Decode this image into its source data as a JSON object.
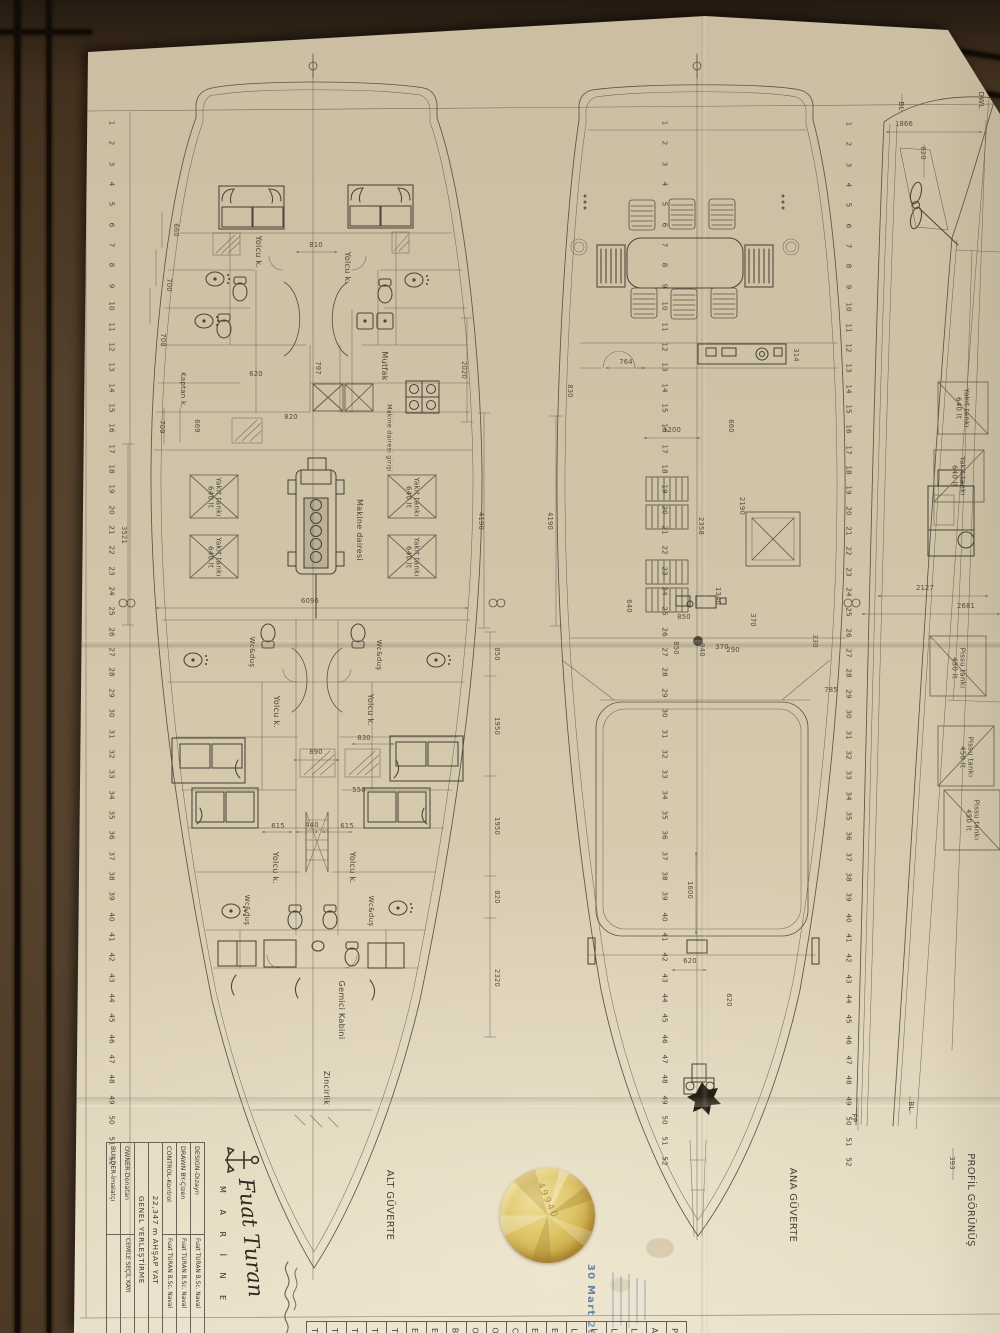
{
  "title_block": {
    "brand_script": "Fuat Turan",
    "brand_sub": "M A R İ N E",
    "rows": [
      {
        "label": "DESIGN-Dizayn",
        "value": "Fuat TURAN B.Sc. Naval"
      },
      {
        "label": "DRAWN BY-Çizen",
        "value": "Fuat TURAN B.Sc. Naval"
      },
      {
        "label": "CONTROL-Kontrol",
        "value": "Fuat TURAN B.Sc. Naval"
      }
    ],
    "boat": "22,347 m AHŞAP YAT",
    "drawing_title": "GENEL YERLEŞTİRME",
    "owner_label": "OWNER-Donatan",
    "owner_value": "CEMİLE SEÇİL KAYI",
    "builder_label": "BUILDER-İmalatçı",
    "builder_value": ""
  },
  "stamp": {
    "date": "30 Mart 2013 /"
  },
  "sticker": {
    "number": "49940"
  },
  "frames": {
    "start": 1,
    "end": 52
  },
  "rulers": [
    {
      "x": 112,
      "y0": 123,
      "dy": 20.35
    },
    {
      "x": 665,
      "y0": 123,
      "dy": 20.35
    },
    {
      "x": 849,
      "y0": 124,
      "dy": 20.35
    }
  ],
  "strip_letters": [
    "T",
    "T",
    "T",
    "T",
    "T",
    "E",
    "E",
    "B",
    "O",
    "O",
    "C",
    "E",
    "E",
    "L",
    "L",
    "L",
    "L",
    "A",
    "P"
  ],
  "annotations": {
    "labels": [
      {
        "text": "Yolcu k.",
        "x": 258,
        "y": 252,
        "v": 1
      },
      {
        "text": "Yolcu k.",
        "x": 347,
        "y": 268,
        "v": 1
      },
      {
        "text": "Mutfak",
        "x": 384,
        "y": 366,
        "v": 1
      },
      {
        "text": "Makine dairesi girişi",
        "x": 389,
        "y": 438,
        "v": 1,
        "fs": 6.2
      },
      {
        "text": "Kaptan k.",
        "x": 183,
        "y": 390,
        "v": 1,
        "fs": 7
      },
      {
        "text": "Yakıt tankı\n640 lt",
        "x": 214,
        "y": 497,
        "v": 1,
        "fs": 7
      },
      {
        "text": "Yakıt tankı\n640 lt",
        "x": 412,
        "y": 497,
        "v": 1,
        "fs": 7
      },
      {
        "text": "Yakıt tankı\n640 lt",
        "x": 214,
        "y": 557,
        "v": 1,
        "fs": 7
      },
      {
        "text": "Yakıt tankı\n640 lt",
        "x": 412,
        "y": 557,
        "v": 1,
        "fs": 7
      },
      {
        "text": "Makine dairesi",
        "x": 359,
        "y": 530,
        "v": 1
      },
      {
        "text": "Wc&duş",
        "x": 252,
        "y": 652,
        "v": 1,
        "fs": 7
      },
      {
        "text": "Wc&duş",
        "x": 379,
        "y": 655,
        "v": 1,
        "fs": 7
      },
      {
        "text": "Yolcu k.",
        "x": 276,
        "y": 712,
        "v": 1
      },
      {
        "text": "Yolcu k.",
        "x": 370,
        "y": 710,
        "v": 1
      },
      {
        "text": "Yolcu k.",
        "x": 275,
        "y": 868,
        "v": 1
      },
      {
        "text": "Yolcu k.",
        "x": 352,
        "y": 868,
        "v": 1
      },
      {
        "text": "Wc&duş",
        "x": 247,
        "y": 910,
        "v": 1,
        "fs": 7
      },
      {
        "text": "Wc&duş",
        "x": 371,
        "y": 911,
        "v": 1,
        "fs": 7
      },
      {
        "text": "Gemici Kabini",
        "x": 341,
        "y": 1010,
        "v": 1
      },
      {
        "text": "Zincirlik",
        "x": 326,
        "y": 1088,
        "v": 1
      },
      {
        "text": "ALT GÜVERTE",
        "x": 389,
        "y": 1205,
        "v": 1,
        "fs": 10
      },
      {
        "text": "ANA GÜVERTE",
        "x": 792,
        "y": 1205,
        "v": 1,
        "fs": 10
      },
      {
        "text": "PROFİL GÖRÜNÜŞ",
        "x": 970,
        "y": 1200,
        "v": 1,
        "fs": 10
      },
      {
        "text": "Pissu tankı\n450 lt",
        "x": 958,
        "y": 668,
        "v": 1,
        "fs": 7
      },
      {
        "text": "Pissu tankı\n450 lt",
        "x": 966,
        "y": 757,
        "v": 1,
        "fs": 7
      },
      {
        "text": "Pissu tankı\n450 lt",
        "x": 972,
        "y": 820,
        "v": 1,
        "fs": 7
      },
      {
        "text": "Yakıt tankı\n640 lt",
        "x": 962,
        "y": 408,
        "v": 1,
        "fs": 7
      },
      {
        "text": "Yakıt tankı\n640 lt",
        "x": 958,
        "y": 476,
        "v": 1,
        "fs": 7
      },
      {
        "text": "BL",
        "x": 901,
        "y": 106,
        "v": 1,
        "fs": 7
      },
      {
        "text": "DWL",
        "x": 981,
        "y": 100,
        "v": 1,
        "fs": 7
      },
      {
        "text": "BL",
        "x": 911,
        "y": 1106,
        "v": 1,
        "fs": 7
      },
      {
        "text": "FP",
        "x": 854,
        "y": 1118,
        "v": 1,
        "fs": 7
      }
    ],
    "dims": [
      {
        "t": "810",
        "x": 316,
        "y": 245,
        "v": 0
      },
      {
        "t": "660",
        "x": 176,
        "y": 230,
        "v": 1
      },
      {
        "t": "700",
        "x": 169,
        "y": 285,
        "v": 1
      },
      {
        "t": "700",
        "x": 163,
        "y": 340,
        "v": 1
      },
      {
        "t": "797",
        "x": 318,
        "y": 368,
        "v": 1
      },
      {
        "t": "620",
        "x": 256,
        "y": 374,
        "v": 0
      },
      {
        "t": "820",
        "x": 291,
        "y": 417,
        "v": 0
      },
      {
        "t": "709",
        "x": 162,
        "y": 427,
        "v": 1
      },
      {
        "t": "669",
        "x": 197,
        "y": 426,
        "v": 1
      },
      {
        "t": "3521",
        "x": 124,
        "y": 535,
        "v": 1
      },
      {
        "t": "2020",
        "x": 464,
        "y": 370,
        "v": 1
      },
      {
        "t": "4190",
        "x": 481,
        "y": 521,
        "v": 1
      },
      {
        "t": "6096",
        "x": 310,
        "y": 601,
        "v": 0
      },
      {
        "t": "850",
        "x": 497,
        "y": 654,
        "v": 1
      },
      {
        "t": "1950",
        "x": 497,
        "y": 726,
        "v": 1
      },
      {
        "t": "1950",
        "x": 497,
        "y": 826,
        "v": 1
      },
      {
        "t": "820",
        "x": 497,
        "y": 897,
        "v": 1
      },
      {
        "t": "2320",
        "x": 497,
        "y": 978,
        "v": 1
      },
      {
        "t": "890",
        "x": 316,
        "y": 752,
        "v": 0
      },
      {
        "t": "830",
        "x": 364,
        "y": 738,
        "v": 0
      },
      {
        "t": "550",
        "x": 359,
        "y": 790,
        "v": 0
      },
      {
        "t": "615",
        "x": 278,
        "y": 826,
        "v": 0
      },
      {
        "t": "440",
        "x": 312,
        "y": 825,
        "v": 0
      },
      {
        "t": "615",
        "x": 347,
        "y": 826,
        "v": 0
      },
      {
        "t": "314",
        "x": 796,
        "y": 355,
        "v": 1
      },
      {
        "t": "764",
        "x": 626,
        "y": 362,
        "v": 0
      },
      {
        "t": "830",
        "x": 570,
        "y": 391,
        "v": 1
      },
      {
        "t": "1200",
        "x": 672,
        "y": 430,
        "v": 0
      },
      {
        "t": "660",
        "x": 731,
        "y": 426,
        "v": 1
      },
      {
        "t": "2190",
        "x": 742,
        "y": 506,
        "v": 1
      },
      {
        "t": "2358",
        "x": 701,
        "y": 526,
        "v": 1
      },
      {
        "t": "4190",
        "x": 550,
        "y": 521,
        "v": 1
      },
      {
        "t": "640",
        "x": 629,
        "y": 606,
        "v": 1
      },
      {
        "t": "1340",
        "x": 718,
        "y": 596,
        "v": 1
      },
      {
        "t": "850",
        "x": 684,
        "y": 617,
        "v": 0
      },
      {
        "t": "370",
        "x": 753,
        "y": 620,
        "v": 1
      },
      {
        "t": "850",
        "x": 676,
        "y": 648,
        "v": 1
      },
      {
        "t": "940",
        "x": 702,
        "y": 650,
        "v": 1
      },
      {
        "t": "370",
        "x": 722,
        "y": 647,
        "v": 0
      },
      {
        "t": "290",
        "x": 733,
        "y": 650,
        "v": 0
      },
      {
        "t": "330",
        "x": 815,
        "y": 641,
        "v": 1
      },
      {
        "t": "785",
        "x": 831,
        "y": 690,
        "v": 0
      },
      {
        "t": "1600",
        "x": 690,
        "y": 890,
        "v": 1
      },
      {
        "t": "620",
        "x": 690,
        "y": 961,
        "v": 0
      },
      {
        "t": "620",
        "x": 729,
        "y": 1000,
        "v": 1
      },
      {
        "t": "1866",
        "x": 904,
        "y": 124,
        "v": 0
      },
      {
        "t": "620",
        "x": 923,
        "y": 153,
        "v": 1
      },
      {
        "t": "2127",
        "x": 925,
        "y": 588,
        "v": 0
      },
      {
        "t": "2681",
        "x": 966,
        "y": 606,
        "v": 0
      },
      {
        "t": "393",
        "x": 952,
        "y": 1163,
        "v": 1
      }
    ]
  }
}
